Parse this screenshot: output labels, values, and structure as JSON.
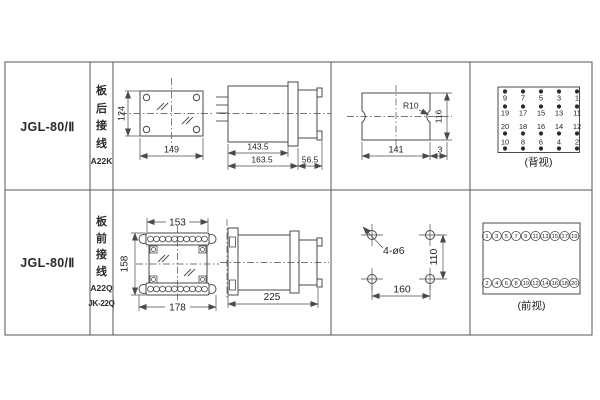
{
  "rows": [
    {
      "model": "JGL-80/Ⅱ",
      "wiring": {
        "chars": [
          "板",
          "后",
          "接",
          "线"
        ],
        "code1": "A22K"
      },
      "front": {
        "h": "124",
        "w": "149"
      },
      "side": {
        "body": "143.5",
        "total": "163.5",
        "rear": "56.5"
      },
      "cutout": {
        "r": "R10",
        "h": "116",
        "w": "141",
        "edge": "3"
      },
      "terminals": {
        "caption": "(背视)",
        "g": [
          [
            "9",
            "7",
            "5",
            "3",
            "1"
          ],
          [
            "19",
            "17",
            "15",
            "13",
            "11"
          ],
          [
            "20",
            "18",
            "16",
            "14",
            "12"
          ],
          [
            "10",
            "8",
            "6",
            "4",
            "2"
          ]
        ]
      }
    },
    {
      "model": "JGL-80/Ⅱ",
      "wiring": {
        "chars": [
          "板",
          "前",
          "接",
          "线"
        ],
        "code1": "A22Q",
        "code2": "JK-22Q"
      },
      "front": {
        "top": "153",
        "h": "158",
        "w": "178"
      },
      "side": {
        "total": "225"
      },
      "drill": {
        "label": "4-ø6",
        "h": "110",
        "w": "160"
      },
      "terminals": {
        "caption": "(前视)",
        "top": [
          "1",
          "3",
          "5",
          "7",
          "9",
          "11",
          "13",
          "15",
          "17",
          "19"
        ],
        "bottom": [
          "2",
          "4",
          "6",
          "8",
          "10",
          "12",
          "14",
          "16",
          "18",
          "20"
        ]
      }
    }
  ]
}
